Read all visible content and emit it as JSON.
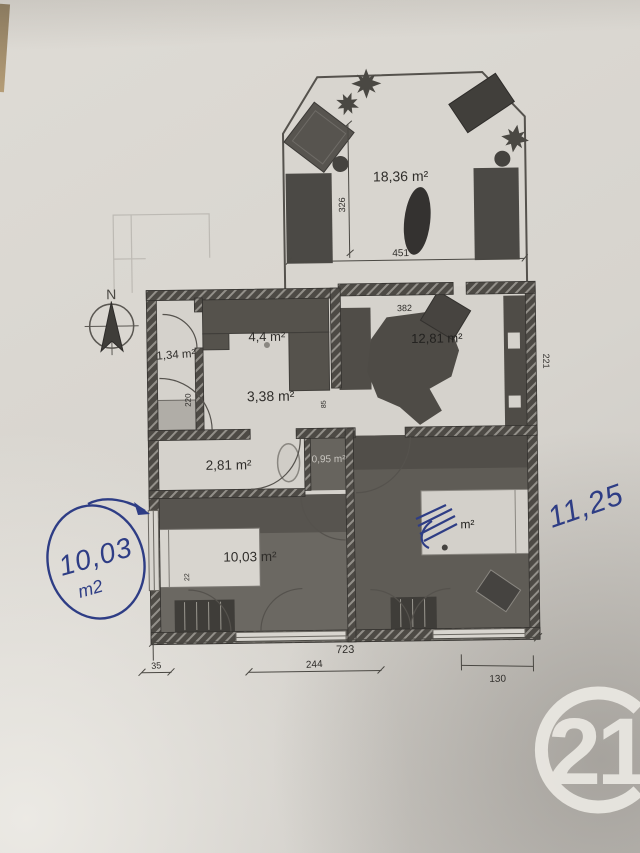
{
  "plan": {
    "terrace": {
      "area": "18,36 m²",
      "width": "451",
      "depth": "326"
    },
    "rooms": {
      "kitchen": "4,4 m²",
      "wc": "1,34 m²",
      "entrance": "3,38 m²",
      "living": "12,81 m²",
      "bathroom": "2,81 m²",
      "closet": "0,95 m²",
      "bedroom_left": "10,03 m²",
      "bedroom_right_unit": "m²"
    },
    "dims": {
      "living_width": "382",
      "living_side": "221",
      "entrance_door": "220",
      "hall": "85",
      "bed": "22",
      "total_width": "723",
      "offset_left": "35",
      "bedroom_left_width": "244",
      "bedroom_right_width": "130"
    },
    "compass_north": "N"
  },
  "handwriting": {
    "circled_value": "10,03",
    "circled_unit": "m2",
    "note_right": "11,25"
  },
  "logo": {
    "number": "21"
  },
  "colors": {
    "ink_blue": "#2e3d85",
    "wall_dark": "#4d4a45",
    "paper": "#d7d4ce"
  }
}
